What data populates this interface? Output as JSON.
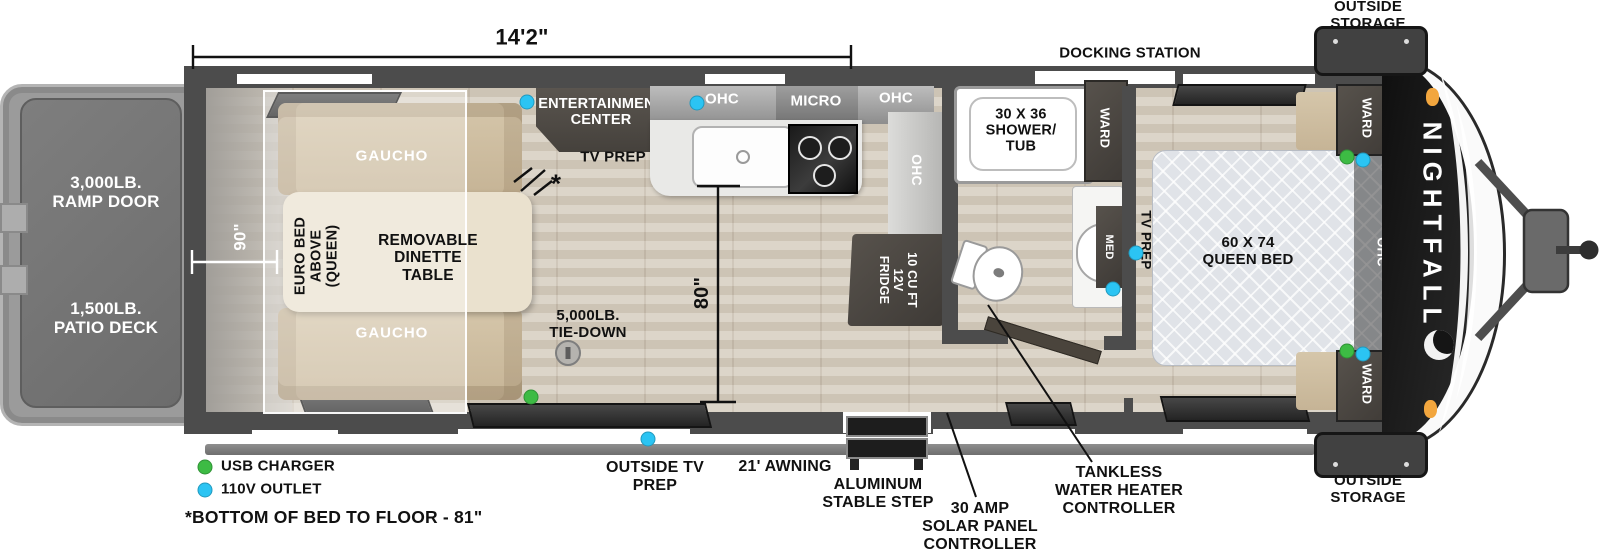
{
  "brand": {
    "name": "NIGHTFALL"
  },
  "dims": {
    "length": "14'2\"",
    "garage_width": "90\"",
    "kitchen_depth": "80\"",
    "asterisk": "*"
  },
  "legend": {
    "usb": "USB CHARGER",
    "outlet": "110V OUTLET",
    "note": "*BOTTOM OF BED TO FLOOR - 81\""
  },
  "exterior": {
    "ramp_door": "3,000LB.\nRAMP DOOR",
    "patio_deck": "1,500LB.\nPATIO DECK",
    "outside_storage_top": "OUTSIDE\nSTORAGE",
    "outside_storage_bottom": "OUTSIDE\nSTORAGE",
    "docking_station": "DOCKING STATION",
    "outside_tv_prep": "OUTSIDE TV\nPREP",
    "awning": "21' AWNING",
    "step": "ALUMINUM\nSTABLE STEP",
    "solar": "30 AMP\nSOLAR PANEL\nCONTROLLER",
    "tankless": "TANKLESS\nWATER HEATER\nCONTROLLER"
  },
  "garage": {
    "gaucho_top": "GAUCHO",
    "gaucho_bottom": "GAUCHO",
    "euro_bed": "EURO BED\nABOVE\n(QUEEN)",
    "dinette": "REMOVABLE\nDINETTE\nTABLE",
    "tie_down": "5,000LB.\nTIE-DOWN"
  },
  "kitchen": {
    "entertainment": "ENTERTAINMENT\nCENTER",
    "tv_prep": "TV PREP",
    "ohc_left": "OHC",
    "micro": "MICRO",
    "ohc_right": "OHC",
    "ohc_side": "OHC",
    "fridge": "10 CU FT\n12V\nFRIDGE"
  },
  "bath": {
    "shower": "30 X 36\nSHOWER/\nTUB",
    "ward": "WARD",
    "med": "MED"
  },
  "bedroom": {
    "tv_prep": "TV PREP",
    "bed": "60 X 74\nQUEEN BED",
    "ohc": "OHC",
    "ward_top": "WARD",
    "ward_bottom": "WARD"
  },
  "colors": {
    "usb_green": "#3dbb44",
    "outlet_blue": "#2bc4f3",
    "marker_amber": "#f2a63e"
  }
}
